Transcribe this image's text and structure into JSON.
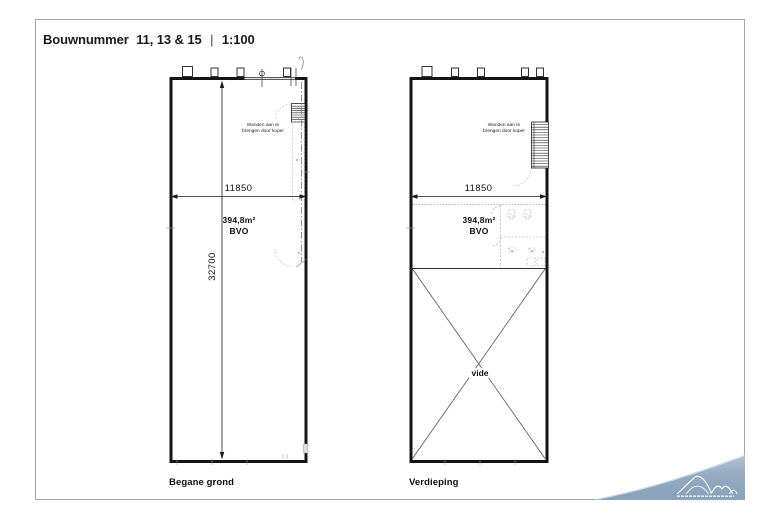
{
  "title": {
    "prefix": "Bouwnummer",
    "numbers": "11, 13 & 15",
    "separator": "|",
    "scale": "1:100"
  },
  "plans": {
    "begane_grond": {
      "label": "Begane grond",
      "width_dim": "11850",
      "depth_dim": "32700",
      "area": "394,8m²",
      "area_type": "BVO",
      "note_line1": "Wanden aan te",
      "note_line2": "brengen door koper"
    },
    "verdieping": {
      "label": "Verdieping",
      "width_dim": "11850",
      "area": "394,8m²",
      "area_type": "BVO",
      "note_line1": "Wanden aan te",
      "note_line2": "brengen door koper",
      "void_label": "vide"
    }
  },
  "colors": {
    "wall": "#141414",
    "frame_border": "#a6a6a6",
    "wave_accent": "#8ca3bc",
    "wave_accent_light": "#b3c2d2"
  }
}
